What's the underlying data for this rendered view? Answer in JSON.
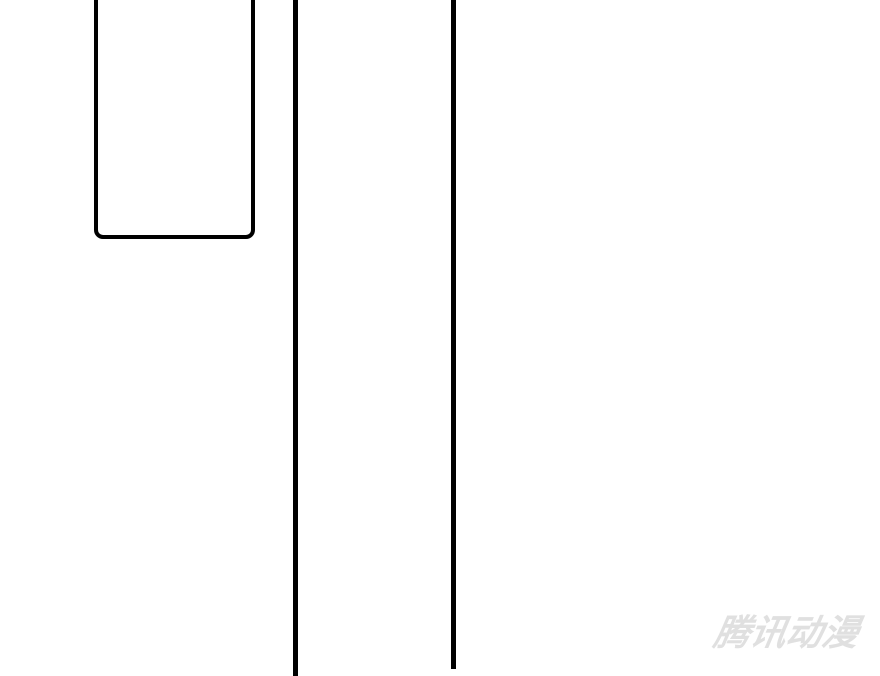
{
  "page": {
    "kind_label": "",
    "palette": {
      "background": "#ffffff",
      "panel_line": "#000000",
      "watermark": "#e0e0e0"
    }
  },
  "watermark": {
    "text": "腾讯动漫"
  }
}
